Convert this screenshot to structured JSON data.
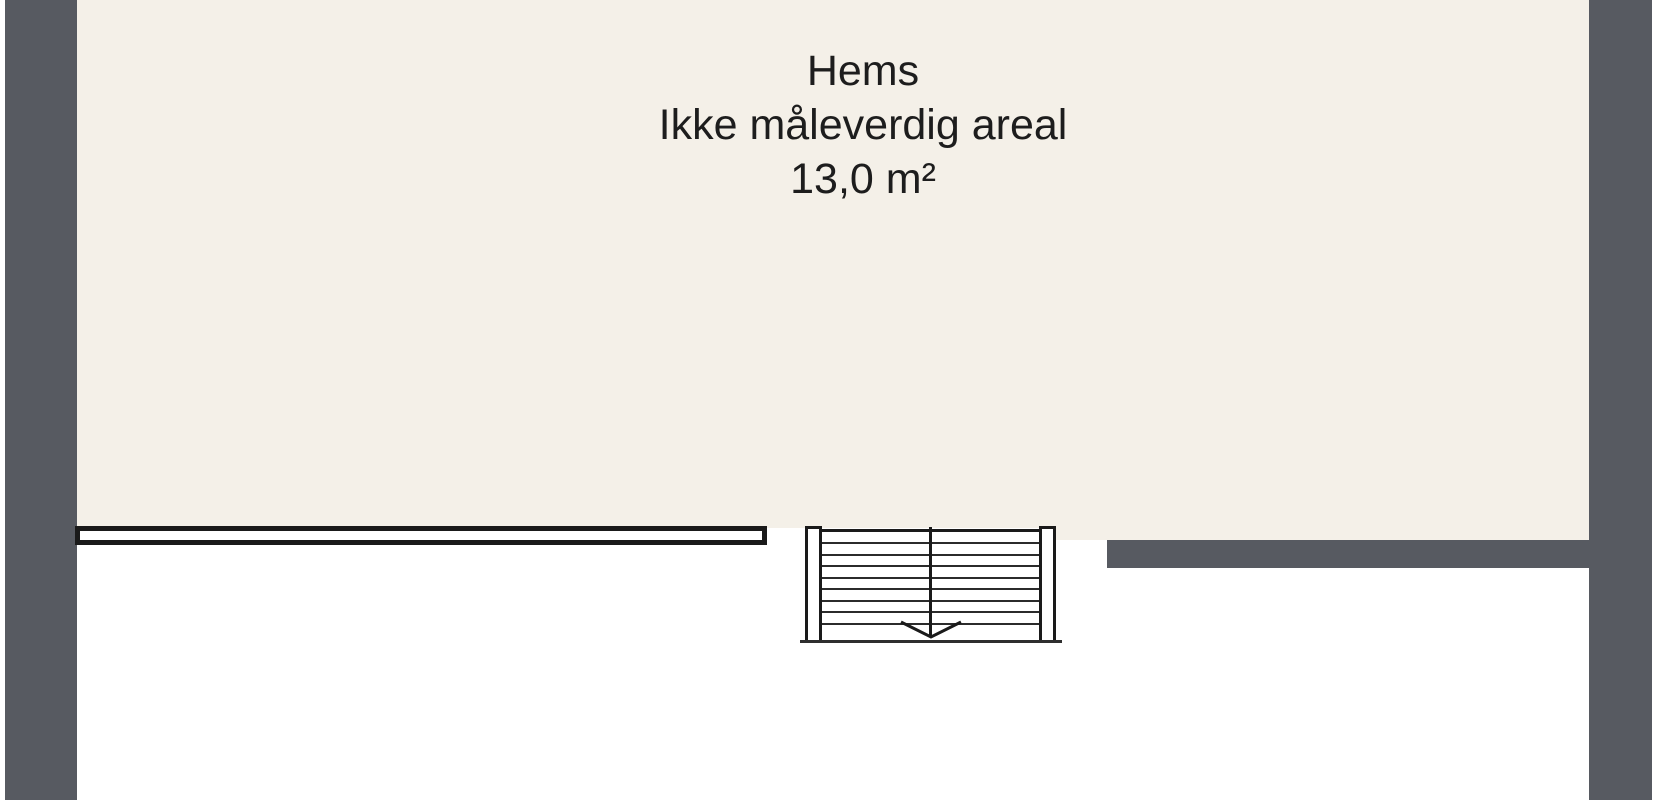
{
  "room": {
    "name": "Hems",
    "note": "Ikke måleverdig areal",
    "area": "13,0 m²"
  },
  "colors": {
    "background": "#FFFFFF",
    "wall": "#575A61",
    "floor": "#F4F0E8",
    "line": "#1A1A1A",
    "text": "#1D1D1D"
  },
  "stair": {
    "type": "straight-double-flight",
    "step_count": 8,
    "direction_arrow": "down"
  }
}
